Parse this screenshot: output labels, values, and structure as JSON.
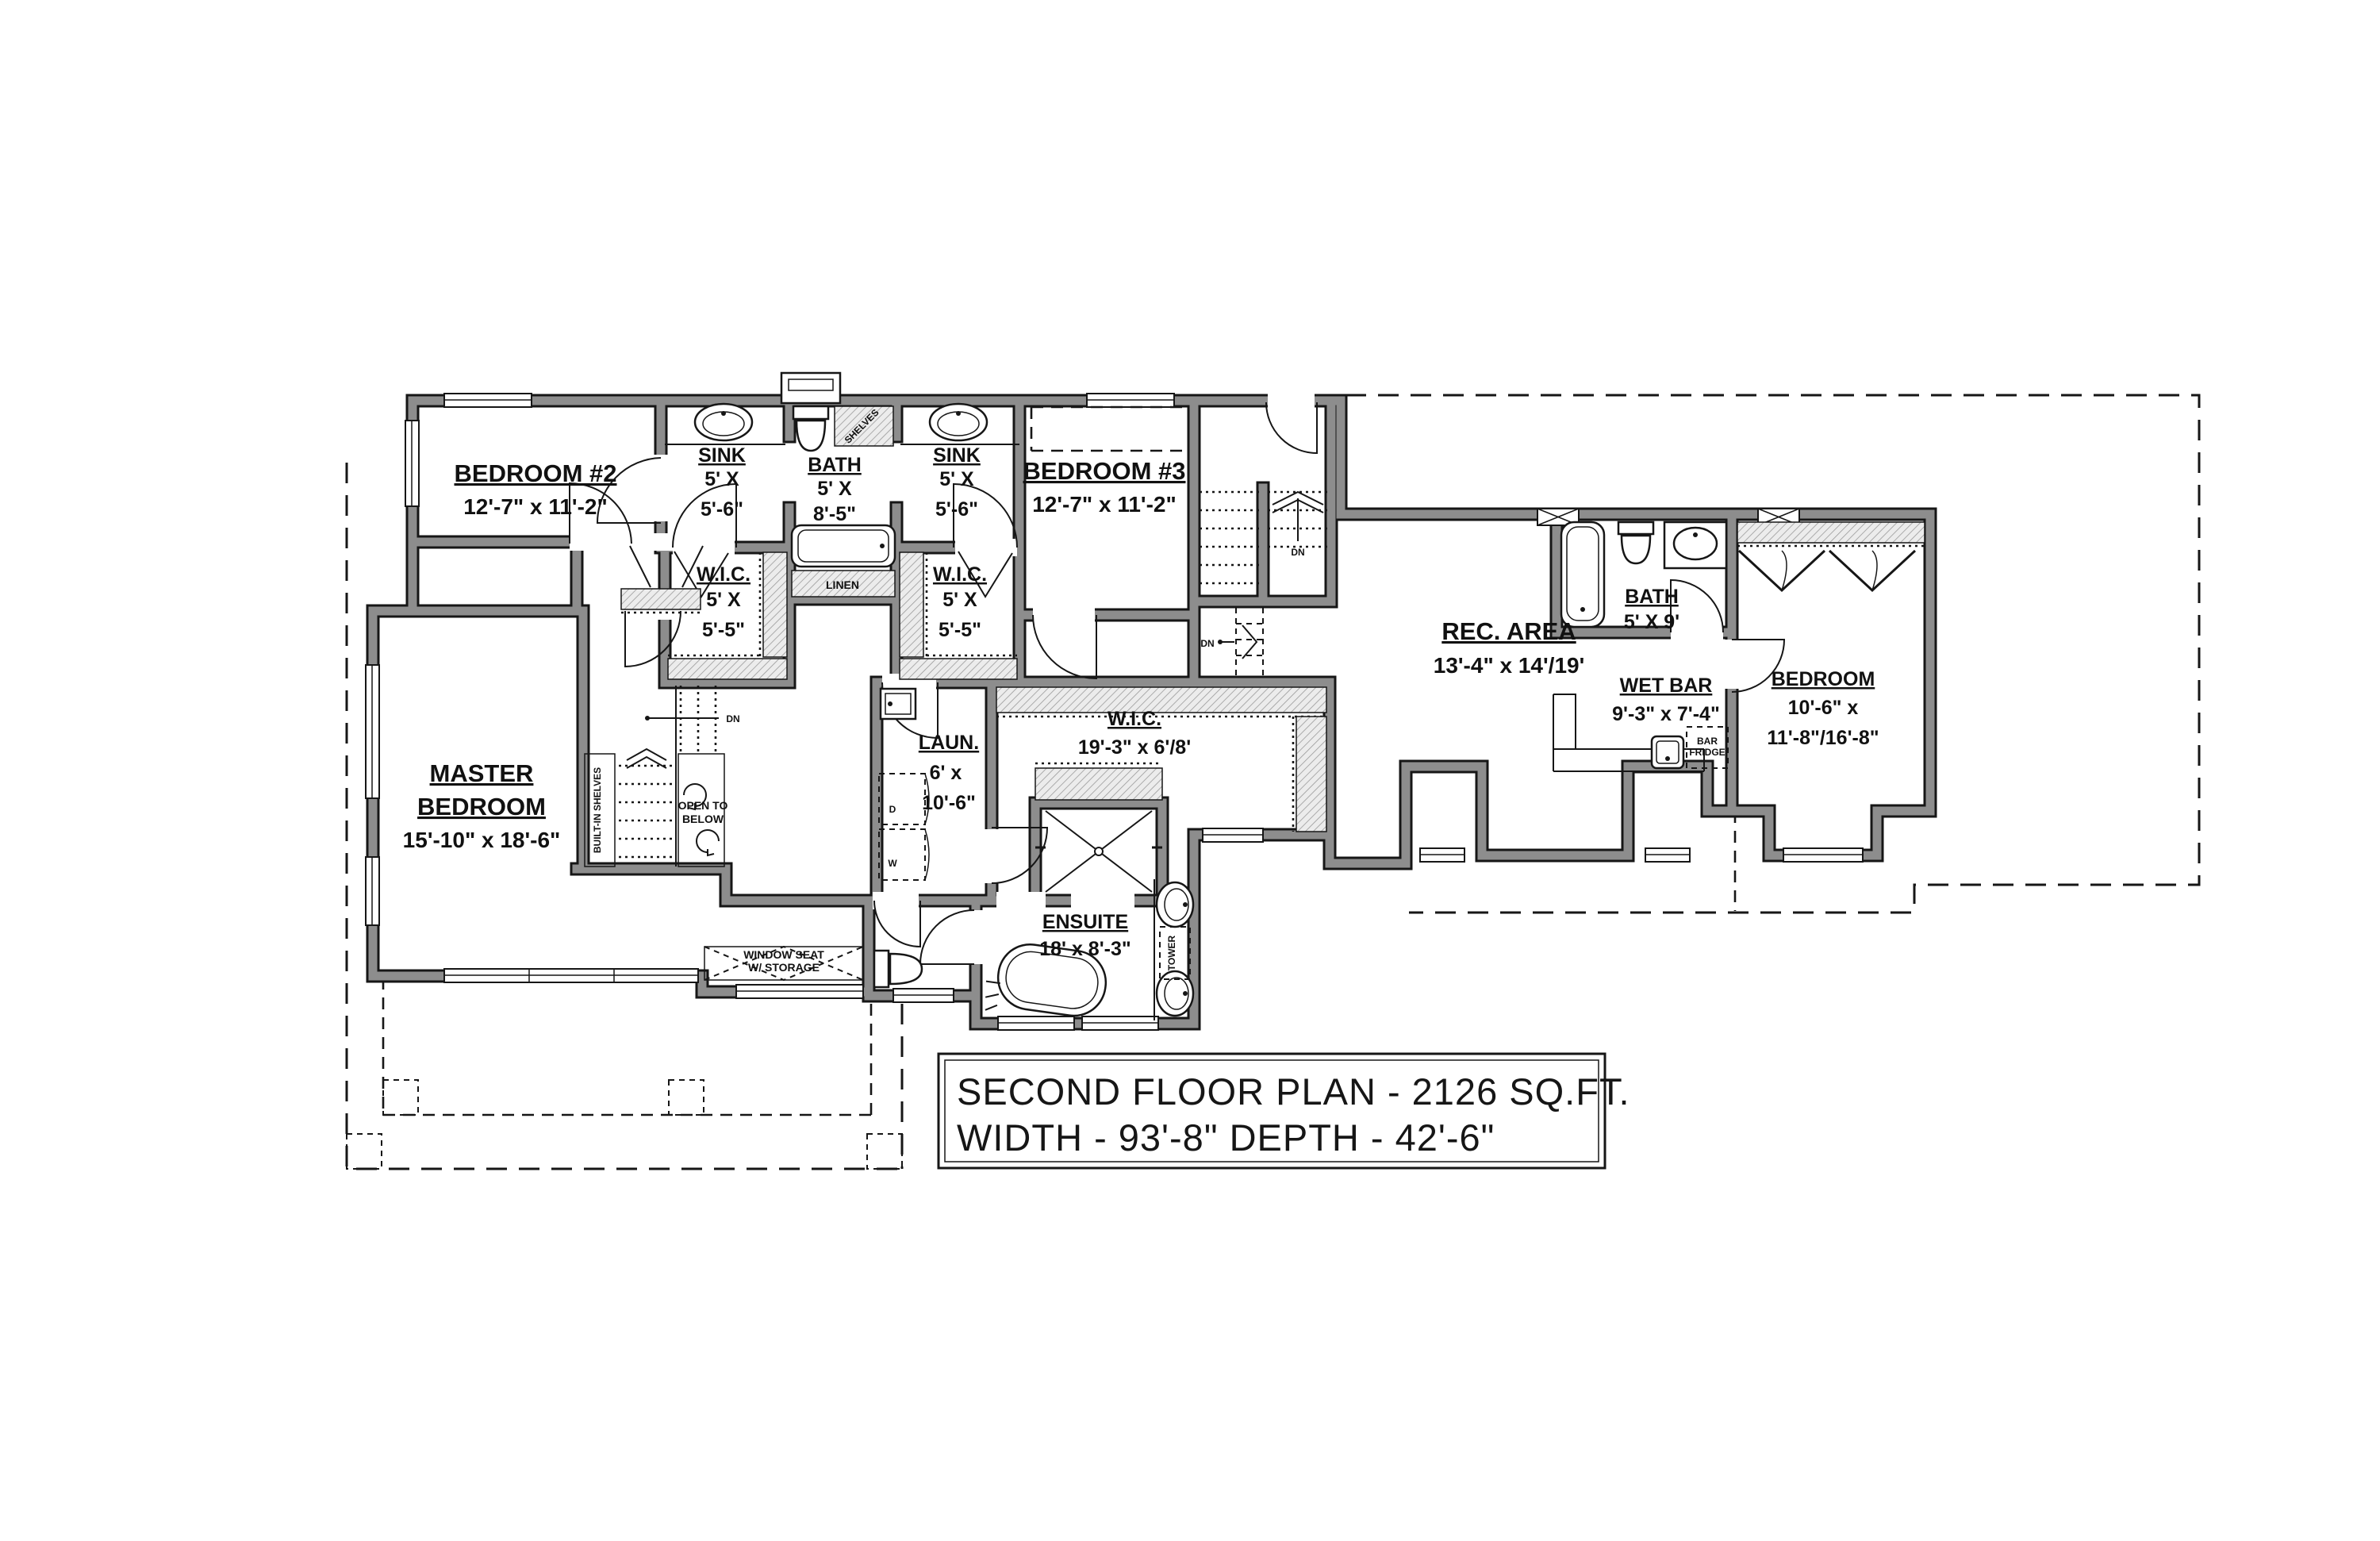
{
  "title_block": {
    "line1": "SECOND FLOOR PLAN - 2126 SQ.FT.",
    "line2": "WIDTH - 93'-8\" DEPTH - 42'-6\""
  },
  "rooms": {
    "bedroom2": {
      "name": "BEDROOM #2",
      "dims": "12'-7\" x 11'-2\""
    },
    "bedroom3": {
      "name": "BEDROOM #3",
      "dims": "12'-7\" x 11'-2\""
    },
    "master": {
      "name1": "MASTER",
      "name2": "BEDROOM",
      "dims": "15'-10\" x 18'-6\""
    },
    "sink_left": {
      "name": "SINK",
      "d1": "5' X",
      "d2": "5'-6\""
    },
    "bath_top": {
      "name": "BATH",
      "d1": "5' X",
      "d2": "8'-5\""
    },
    "sink_right": {
      "name": "SINK",
      "d1": "5' X",
      "d2": "5'-6\""
    },
    "wic_left": {
      "name": "W.I.C.",
      "d1": "5' X",
      "d2": "5'-5\""
    },
    "wic_right": {
      "name": "W.I.C.",
      "d1": "5' X",
      "d2": "5'-5\""
    },
    "wic_master": {
      "name": "W.I.C.",
      "dims": "19'-3\" x 6'/8'"
    },
    "laundry": {
      "name": "LAUN.",
      "d1": "6' x",
      "d2": "10'-6\""
    },
    "ensuite": {
      "name": "ENSUITE",
      "dims": "18' x 8'-3\""
    },
    "rec_area": {
      "name": "REC. AREA",
      "dims": "13'-4\" x 14'/19'"
    },
    "bath_right": {
      "name": "BATH",
      "dims": "5' X 9'"
    },
    "wet_bar": {
      "name": "WET BAR",
      "dims": "9'-3\" x 7'-4\""
    },
    "bedroom_right": {
      "name": "BEDROOM",
      "d1": "10'-6\" x",
      "d2": "11'-8\"/16'-8\""
    }
  },
  "annotations": {
    "linen": "LINEN",
    "shelves": "SHELVES",
    "tower": "TOWER",
    "bar_fridge1": "BAR",
    "bar_fridge2": "FRIDGE",
    "open_to_below1": "OPEN TO",
    "open_to_below2": "BELOW",
    "built_in_shelves": "BUILT-IN SHELVES",
    "window_seat1": "WINDOW SEAT",
    "window_seat2": "W/ STORAGE",
    "dn": "DN",
    "dryer": "D",
    "washer": "W"
  },
  "colors": {
    "wall_gray": "#8d8d8d",
    "line_black": "#161616",
    "background": "#ffffff"
  }
}
